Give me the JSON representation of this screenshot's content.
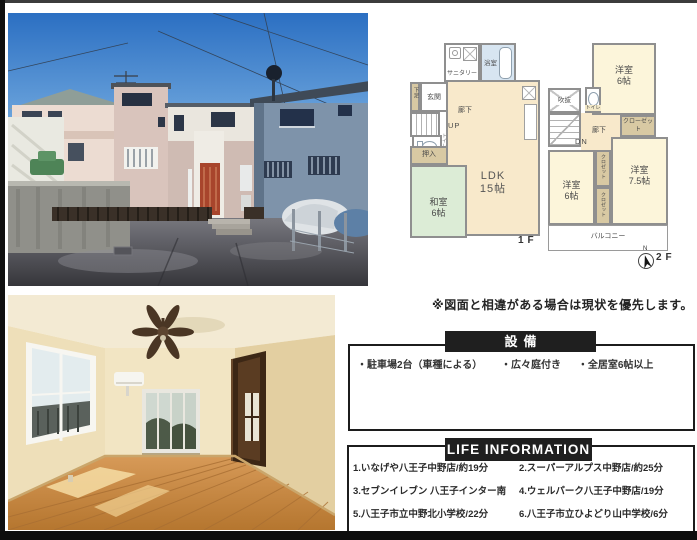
{
  "note": "※図面と相違がある場合は現状を優先します。",
  "colors": {
    "header_bg": "#1f1f1f",
    "header_text": "#ffffff",
    "plan_wall": "#8f8f8f",
    "plan_room_cream": "#fcf5da",
    "plan_ldk_beige": "#f8e9cb",
    "plan_tatami_green": "#dcecd6",
    "plan_bath_blue": "#d7e5f1",
    "plan_closet_tan": "#d8c9a3"
  },
  "floorplan": {
    "f1": {
      "floor_label": "1F",
      "sanitary": "サニタリー",
      "bath": "浴室",
      "shoes": "下足",
      "entrance": "玄関",
      "hallway": "廊下",
      "up": "UP",
      "toilet": "トイレ",
      "oshiire": "押入",
      "washitsu": "和室",
      "washitsu_size": "6帖",
      "ldk": "LDK",
      "ldk_size": "15帖"
    },
    "f2": {
      "floor_label": "2F",
      "void_label": "吹抜",
      "toilet": "トイレ",
      "room1": "洋室",
      "room1_size": "6帖",
      "closet": "クローゼット",
      "hallway": "廊下",
      "down": "DN",
      "room2": "洋室",
      "room2_size": "6帖",
      "closet_small1": "クロゼット",
      "closet_small2": "クロゼット",
      "room3": "洋室",
      "room3_size": "7.5帖",
      "balcony": "バルコニー",
      "compass_n": "N"
    }
  },
  "facilities": {
    "title": "設備",
    "items": [
      "・駐車場2台（車種による）",
      "・広々庭付き",
      "・全居室6帖以上"
    ]
  },
  "life_information": {
    "title": "LIFE INFORMATION",
    "items": [
      "1.いなげや八王子中野店/約19分",
      "2.スーパーアルプス中野店/約25分",
      "3.セブンイレブン 八王子インター南",
      "4.ウェルパーク八王子中野店/19分",
      "5.八王子市立中野北小学校/22分",
      "6.八王子市立ひよどり山中学校/6分"
    ]
  }
}
